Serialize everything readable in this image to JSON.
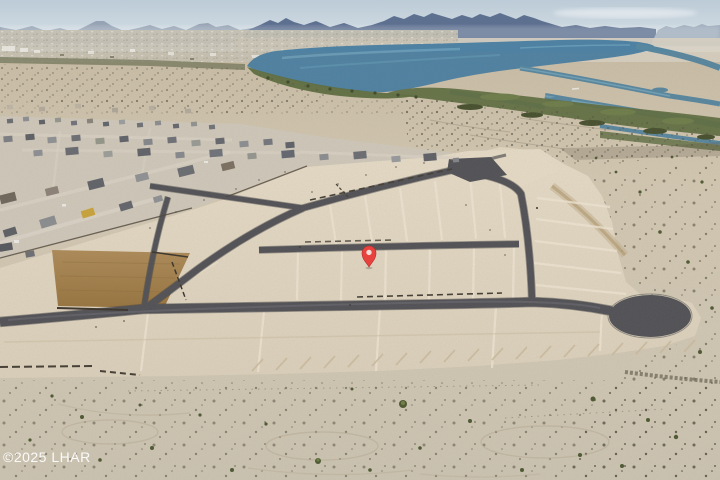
{
  "image": {
    "kind": "aerial-drone-photo",
    "description": "Aerial photo of a desert subdivision under construction: bright graded lots with new dark asphalt roads and a cul-de-sac, an existing stucco-home neighborhood on the left, a brown dirt basin, natural desert with shrubs in the foreground, and a blue river with green marshes and hazy mountains at the horizon. A red map pin marks a lot near center.",
    "width": 720,
    "height": 480
  },
  "watermark": {
    "text": "©2025 LHAR",
    "color": "#ffffff"
  },
  "marker": {
    "type": "map-pin",
    "fill": "#e8423e",
    "stroke": "#b22e2c",
    "inner_fill": "#f3ddd6",
    "transform": "translate(369,253)"
  },
  "palette": {
    "sky_top": "#bccbd7",
    "sky_horizon": "#e0e7eb",
    "mountains_far": "#96a3b4",
    "mountains_near": "#5d7090",
    "mountains_right": "#9dabbb",
    "water": "#4e81a2",
    "marsh_green": "#5f6e41",
    "desert_base": "#d2c7b1",
    "graded_sand_light": "#e6dbc7",
    "graded_sand_dark": "#dbd0bb",
    "asphalt": "#515156",
    "dirt_basin": "#ad8a58",
    "roof_dark": "#5d6066",
    "roof_light": "#96989c",
    "accent_building_yellow": "#c9a33b"
  }
}
